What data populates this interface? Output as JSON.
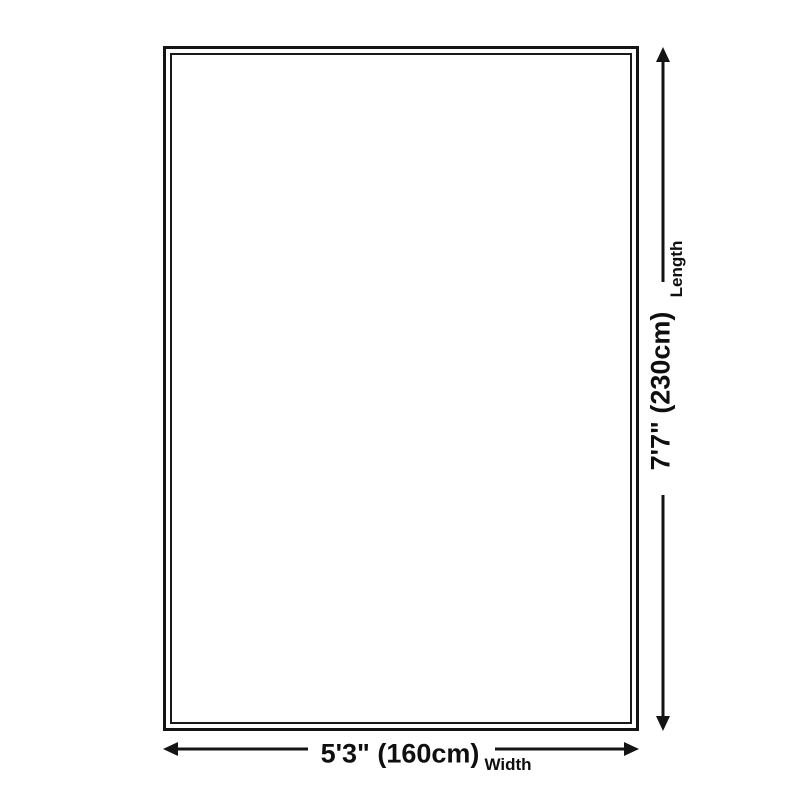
{
  "diagram": {
    "type": "product-dimension-diagram",
    "colors": {
      "background": "#ffffff",
      "line": "#141414",
      "text": "#0f0f0f"
    },
    "width": {
      "value": "5'3\" (160cm)",
      "label": "Width"
    },
    "length": {
      "value": "7'7\" (230cm)",
      "label": "Length"
    }
  }
}
